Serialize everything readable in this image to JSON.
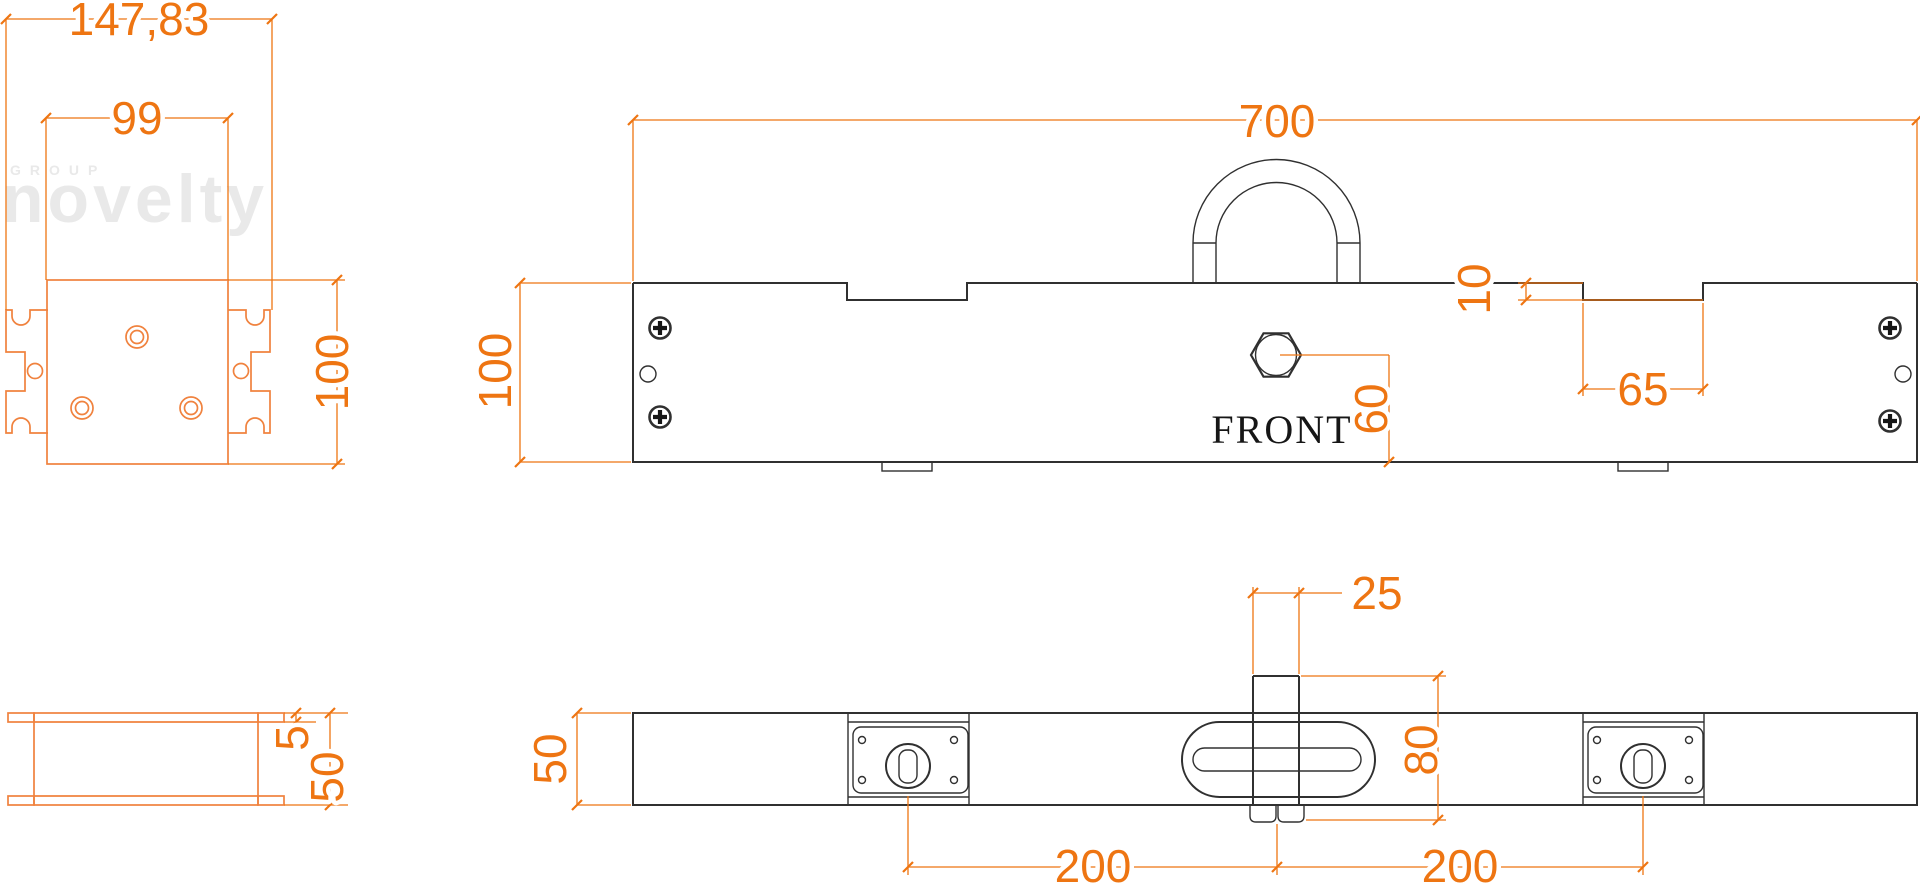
{
  "watermark": {
    "line1": "GROUP",
    "line2": "novelty"
  },
  "front_view": {
    "label": "FRONT"
  },
  "dims": {
    "claw_overall": "147,83",
    "plate_width": "99",
    "height_left_view": "100",
    "beam_length": "700",
    "beam_height": "100",
    "notch_depth": "10",
    "notch_width": "65",
    "boss_height": "60",
    "stem_width": "25",
    "stem_span": "80",
    "plan_depth": "50",
    "tab_thickness": "5",
    "end_depth": "50",
    "pitch_left": "200",
    "pitch_right": "200"
  },
  "colors": {
    "dim": "#ee7512",
    "part_secondary": "#f0823e",
    "part_primary": "#303030",
    "watermark": "#e9e9e9"
  }
}
